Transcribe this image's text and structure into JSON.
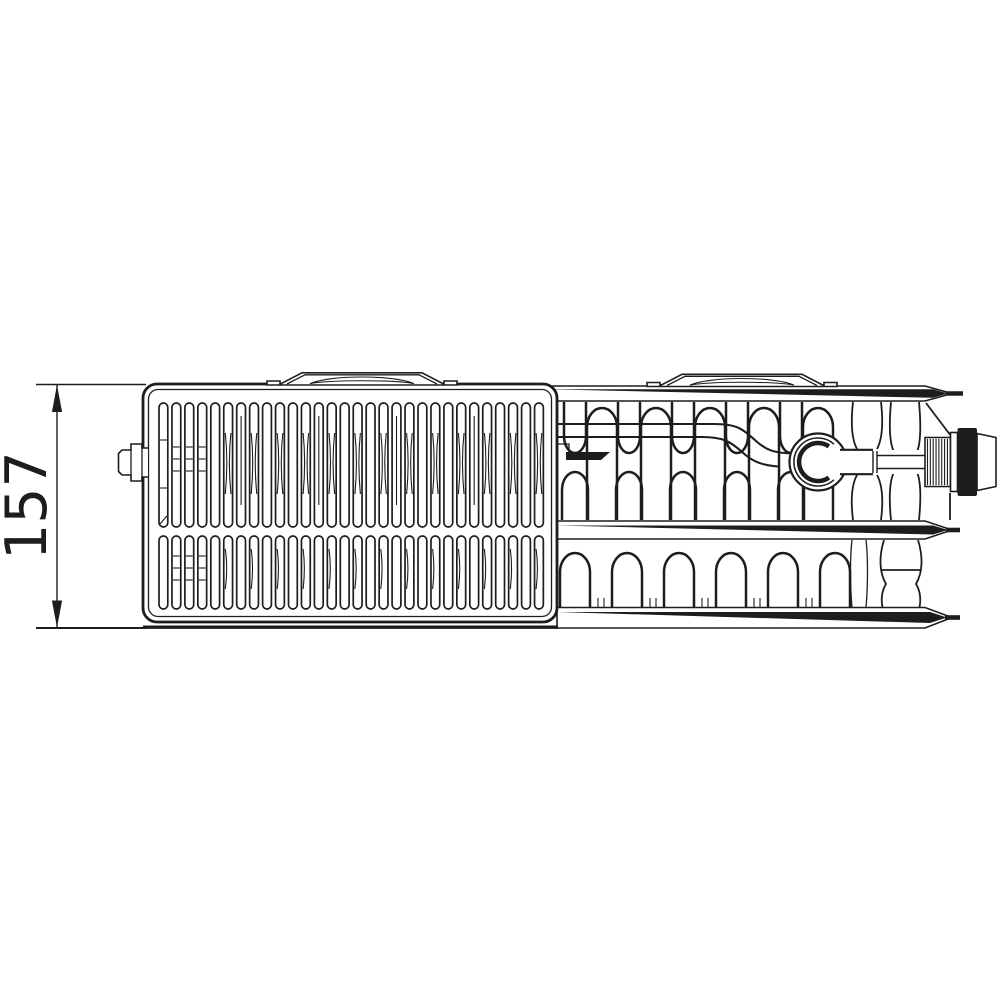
{
  "meta": {
    "description": "Technical line drawing: top view of a panel radiator (type 33) with partial grille, convector fins, connection valve and height dimension"
  },
  "colors": {
    "background": "#ffffff",
    "line": "#1d1d1b"
  },
  "dimension": {
    "height_label": "157"
  },
  "drawing": {
    "grille": {
      "slat_columns": 30,
      "slat_rows": 2
    },
    "fins": {
      "upper_tall_loops": 5,
      "upper_hanging_loops": 5,
      "upper_bumps": 5,
      "lower_loops": 6
    },
    "valve": {
      "thread_lines": 8
    }
  }
}
